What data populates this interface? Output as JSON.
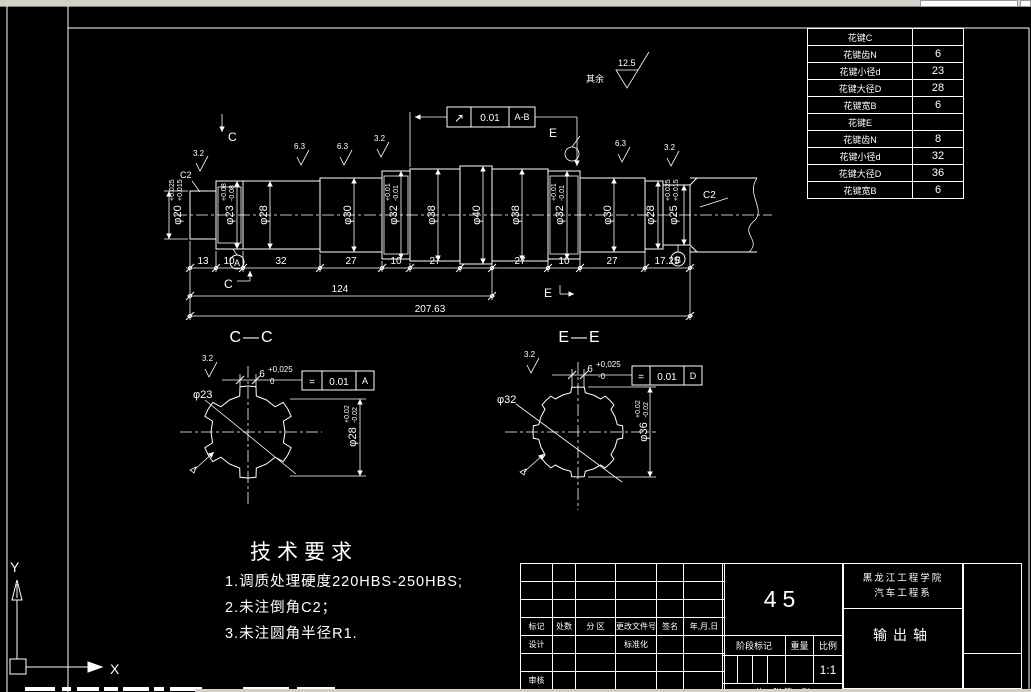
{
  "colors": {
    "bg": "#000000",
    "line": "#ffffff",
    "chrome": "#d4d0c8"
  },
  "ucs": {
    "x_label": "X",
    "y_label": "Y"
  },
  "ann": {
    "qiyu": "其余",
    "rough_125": "12.5",
    "rough_63": "6.3",
    "rough_32": "3.2",
    "c2": "C2",
    "runout_sym": "↗",
    "runout_val": "0.01",
    "runout_datum": "A-B",
    "sec_c": "C",
    "sec_e": "E",
    "datum_a": "A",
    "datum_b": "B"
  },
  "dims": {
    "d13": "13",
    "d10": "10",
    "d32": "32",
    "d27": "27",
    "d1725": "17.25",
    "d124": "124",
    "dtotal": "207.63"
  },
  "shaft": {
    "d20b": "φ20",
    "d20u": "+0.025",
    "d20l": "+0.015",
    "d23b": "φ23",
    "d23u": "+0.08",
    "d23l": "-0.08",
    "d28": "φ28",
    "d30": "φ30",
    "d32b": "φ32",
    "d32u": "+0.01",
    "d32l": "-0.01",
    "d38": "φ38",
    "d40": "φ40",
    "d25b": "φ25",
    "d25u": "+0.025",
    "d25l": "+0.015"
  },
  "cc": {
    "title": "C—C",
    "w": "6",
    "wu": "+0,025",
    "wl": "0",
    "sym": "=",
    "tol": "0.01",
    "datum": "A",
    "minor": "φ23",
    "majorb": "φ28",
    "majoru": "+0.02",
    "majorl": "-0.02",
    "rough": "3.2"
  },
  "ee": {
    "title": "E—E",
    "w": "6",
    "wu": "+0,025",
    "wl": "-0",
    "sym": "=",
    "tol": "0.01",
    "datum": "D",
    "minor": "φ32",
    "majorb": "φ36",
    "majoru": "+0.02",
    "majorl": "-0.02",
    "rough": "3.2"
  },
  "tech": {
    "title": "技术要求",
    "item1": "1.调质处理硬度220HBS-250HBS;",
    "item2": "2.未注倒角C2；",
    "item3": "3.未注圆角半径R1."
  },
  "spline_table": {
    "rows": [
      {
        "label": "花键C",
        "value": ""
      },
      {
        "label": "花键齿N",
        "value": "6"
      },
      {
        "label": "花键小径d",
        "value": "23"
      },
      {
        "label": "花键大径D",
        "value": "28"
      },
      {
        "label": "花键宽B",
        "value": "6"
      },
      {
        "label": "花键E",
        "value": ""
      },
      {
        "label": "花键齿N",
        "value": "8"
      },
      {
        "label": "花键小径d",
        "value": "32"
      },
      {
        "label": "花键大径D",
        "value": "36"
      },
      {
        "label": "花键宽B",
        "value": "6"
      }
    ]
  },
  "tb": {
    "material": "45",
    "h_mark": "标记",
    "h_count": "处数",
    "h_zone": "分 区",
    "h_file": "更改文件号",
    "h_sign": "签名",
    "h_date": "年,月,日",
    "design": "设计",
    "std": "标准化",
    "check": "审核",
    "stage": "阶段标记",
    "weight": "重量",
    "scale": "比例",
    "scale_val": "1:1",
    "sheets": "共13张 第12张",
    "school1": "黑龙江工程学院",
    "school2": "汽车工程系",
    "part": "输出轴"
  }
}
